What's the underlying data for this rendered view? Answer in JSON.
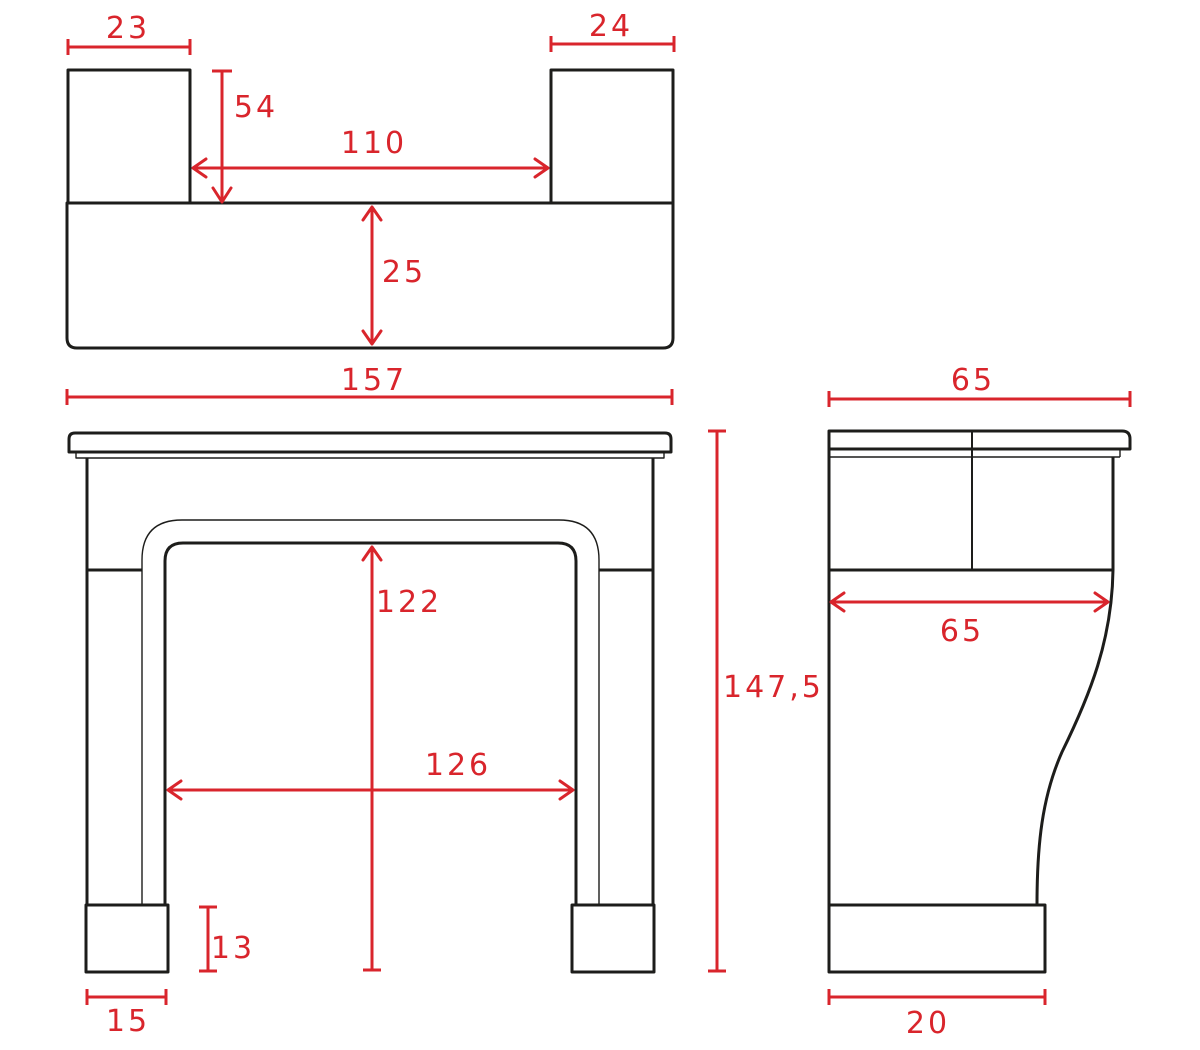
{
  "colors": {
    "outline": "#1d1d1b",
    "dimension": "#d9252c",
    "background": "#ffffff"
  },
  "views": {
    "top": {
      "title": "top-view-plan-of-mantel-shelf",
      "dims": {
        "left_block_width": "23",
        "right_block_width": "24",
        "return_depth": "54",
        "inner_width": "110",
        "shelf_depth": "25"
      }
    },
    "front": {
      "title": "front-elevation-of-fireplace-surround",
      "dims": {
        "overall_width": "157",
        "overall_height": "147,5",
        "opening_height": "122",
        "opening_width": "126",
        "plinth_height": "13",
        "plinth_width": "15"
      }
    },
    "side": {
      "title": "side-profile-of-fireplace-surround",
      "dims": {
        "shelf_depth": "65",
        "frieze_depth": "65",
        "plinth_depth": "20"
      }
    }
  }
}
